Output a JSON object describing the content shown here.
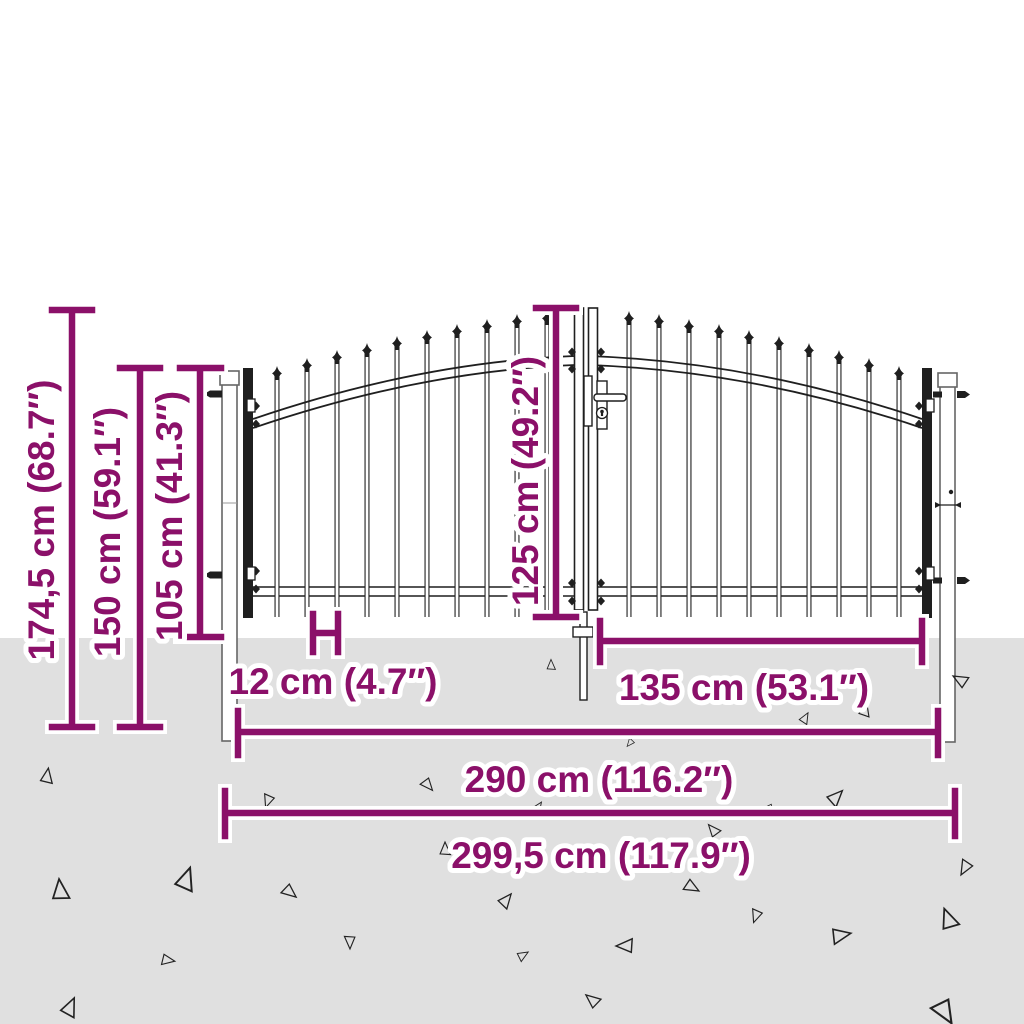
{
  "colors": {
    "accent": "#8b1069",
    "ground": "#e0e0e0",
    "ink": "#1f1f1f",
    "background": "#ffffff"
  },
  "diagram": {
    "subject": "double-door-garden-gate-with-spear-top",
    "dimensions": {
      "total_height": "174,5 cm (68.7″)",
      "gate_height_with_posts": "150 cm (59.1″)",
      "side_height": "105 cm (41.3″)",
      "center_height": "125 cm (49.2″)",
      "bar_spacing": "12 cm (4.7″)",
      "single_door_width": "135 cm (53.1″)",
      "inner_width": "290 cm (116.2″)",
      "total_width": "299,5 cm (117.9″)"
    }
  }
}
